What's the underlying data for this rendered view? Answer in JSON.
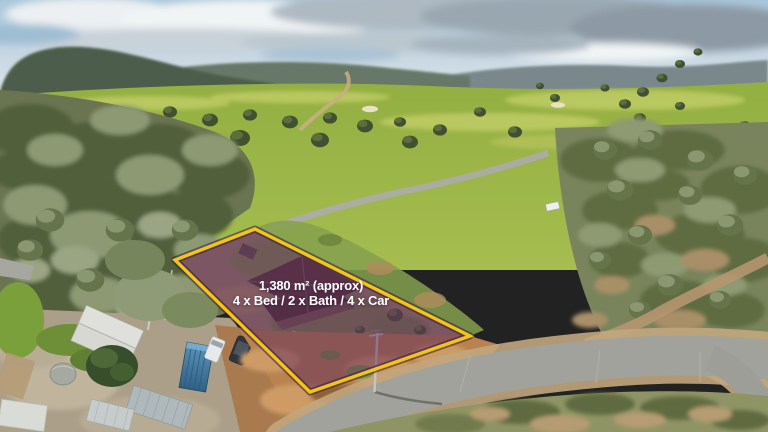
{
  "overlay": {
    "line1": "1,380 m² (approx)",
    "line2": "4 x Bed / 2 x Bath / 4 x Car",
    "boundary_color": "#F6C319",
    "boundary_shadow_color": "rgba(42,28,58,0.55)",
    "fill_color": "rgba(100,45,92,0.52)",
    "text_color": "#FFFFFF"
  },
  "scene": {
    "palette": {
      "sky": "#AEC9DC",
      "cloud_white": "#EEF1F3",
      "cloud_grey": "#97A4AF",
      "hills": "#6B7B72",
      "field_green": "#9CB545",
      "bush_olive": "#68734C",
      "road_grey": "#A2A29C",
      "dirt_tan": "#B9824F"
    }
  }
}
